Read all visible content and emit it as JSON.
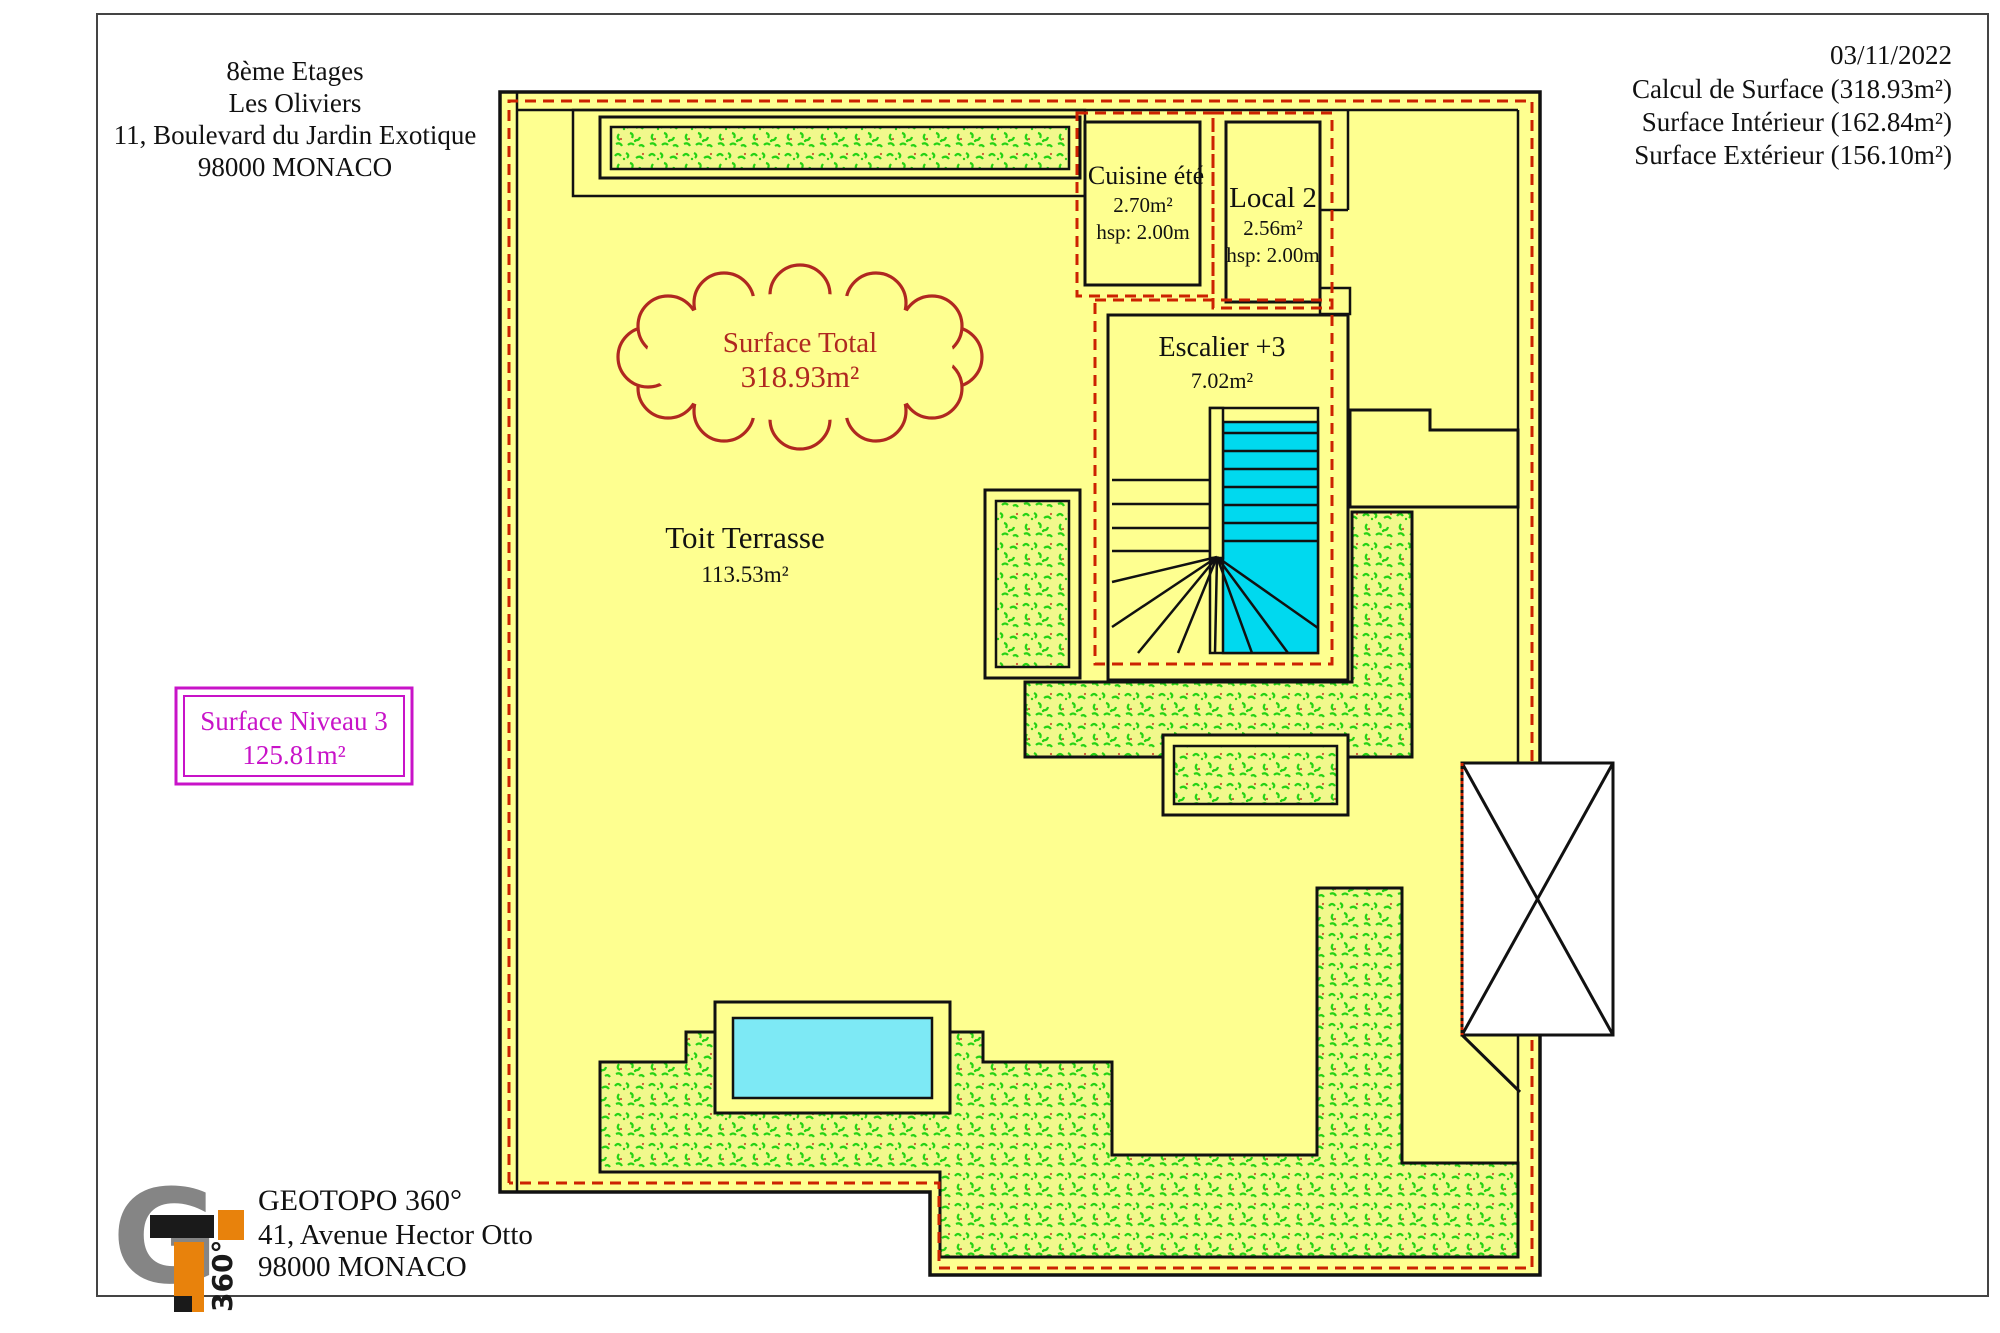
{
  "header_left": {
    "lines": [
      "8ème Etages",
      "Les Oliviers",
      "11, Boulevard du Jardin Exotique",
      "98000 MONACO"
    ]
  },
  "header_right": {
    "lines": [
      "03/11/2022",
      "Calcul de Surface (318.93m²)",
      "Surface Intérieur (162.84m²)",
      "Surface Extérieur (156.10m²)"
    ]
  },
  "plan": {
    "surface_total": {
      "title": "Surface Total",
      "value": "318.93m²"
    },
    "toit_terrasse": {
      "title": "Toit Terrasse",
      "value": "113.53m²"
    },
    "cuisine": {
      "title": "Cuisine été",
      "area": "2.70m²",
      "height": "hsp: 2.00m"
    },
    "local2": {
      "title": "Local 2",
      "area": "2.56m²",
      "height": "hsp: 2.00m"
    },
    "escalier": {
      "title": "Escalier +3",
      "area": "7.02m²"
    },
    "niveau3": {
      "title": "Surface Niveau 3",
      "value": "125.81m²"
    }
  },
  "footer": {
    "company": "GEOTOPO 360°",
    "address": "41, Avenue Hector Otto",
    "city": "98000 MONACO",
    "logo_g": "G",
    "logo_360": "360°"
  },
  "colors": {
    "terrace_yellow": "#feff90",
    "vegetation_green": "#25d315",
    "stairs_cyan": "#00d9ef",
    "pool_cyan": "#7de9f5",
    "boundary_red_dash": "#cc2200",
    "cloud_dark_red": "#b02820",
    "niveau_magenta": "#c813c8",
    "logo_orange": "#e8820c",
    "logo_gray": "#858585"
  }
}
